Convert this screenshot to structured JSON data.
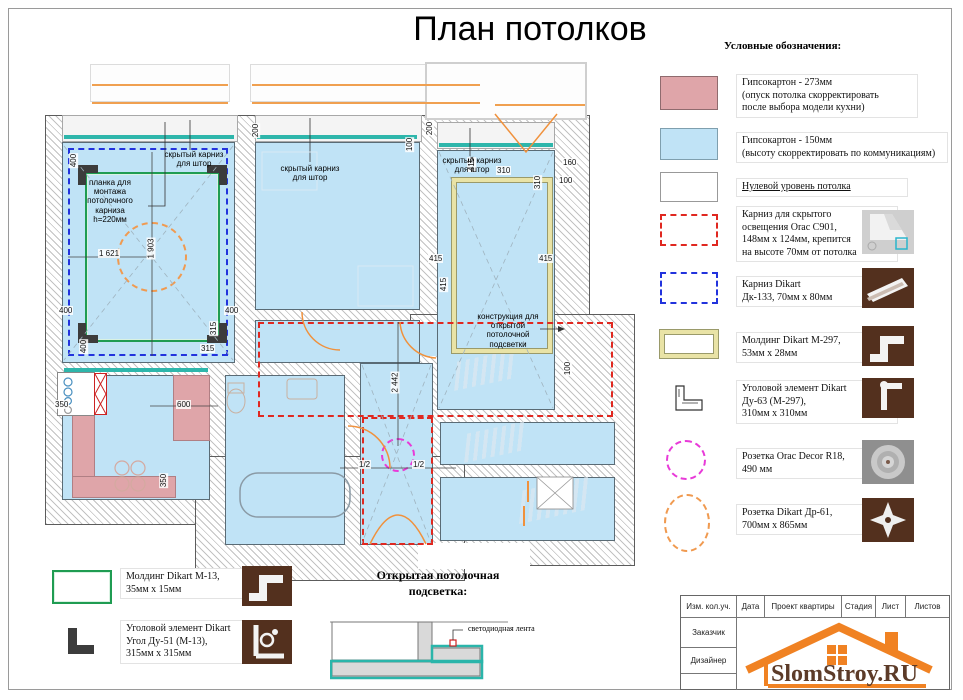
{
  "title": "План потолков",
  "legend": {
    "header": "Условные обозначения:",
    "items": [
      {
        "label": "Гипсокартон - 273мм\n(опуск потолка скорректировать\nпосле выбора модели кухни)"
      },
      {
        "label": "Гипсокартон - 150мм\n(высоту скорректировать по коммуникациям)"
      },
      {
        "label": "Нулевой уровень потолка"
      },
      {
        "label": "Карниз для скрытого\nосвещения Orac C901,\n148мм х 124мм, крепится\nна высоте 70мм от потолка"
      },
      {
        "label": "Карниз Dikart\nДк-133, 70мм х 80мм"
      },
      {
        "label": "Молдинг Dikart М-297,\n53мм х 28мм"
      },
      {
        "label": "Уголовой элемент Dikart\nДу-63 (М-297),\n310мм х 310мм"
      },
      {
        "label": "Розетка Orac Decor R18,\n490 мм"
      },
      {
        "label": "Розетка Dikart Др-61,\n700мм х 865мм"
      }
    ]
  },
  "plan": {
    "labels": {
      "curtain": "скрытый карниз\nдля штор",
      "plank": "планка для\nмонтажа\nпотолочного\nкарниза\nh=220мм",
      "construction": "конструкция для\nоткрытой\nпотолочной\nподсветки"
    },
    "dims": {
      "d1621": "1 621",
      "d1903": "1 903",
      "d2442": "2 442",
      "d400": "400",
      "d315": "315",
      "d350": "350",
      "d600": "600",
      "d200": "200",
      "d100": "100",
      "d415": "415",
      "d310": "310",
      "d160": "160",
      "dhalf": "1/2"
    }
  },
  "bottom_legend": {
    "molding_m13": "Молдинг Dikart М-13,\n35мм х 15мм",
    "corner_du51": "Уголовой элемент Dikart\nУгол Ду-51 (М-13),\n315мм х 315мм"
  },
  "light_section": {
    "heading": "Открытая потолочная\nподсветка:",
    "led_label": "светодиодная лента"
  },
  "titleblock": {
    "headers": [
      "Изм. кол.уч.",
      "Дата",
      "Проект квартиры",
      "Стадия",
      "Лист",
      "Листов"
    ],
    "rows": [
      "Заказчик",
      "Дизайнер"
    ],
    "logo": "SlomStroy.RU"
  },
  "colors": {
    "gypsum_273": "#dfa5a9",
    "gypsum_150": "#c0e3f6",
    "teal": "#2eb6ab",
    "cornice_red": "#e02820",
    "cornice_blue": "#2233dd",
    "molding_yellow": "#e9e3a6",
    "rosette_magenta": "#e83ad8",
    "rosette_orange": "#f09a50",
    "logo_orange": "#f08223",
    "logo_brown": "#5c3b28"
  }
}
